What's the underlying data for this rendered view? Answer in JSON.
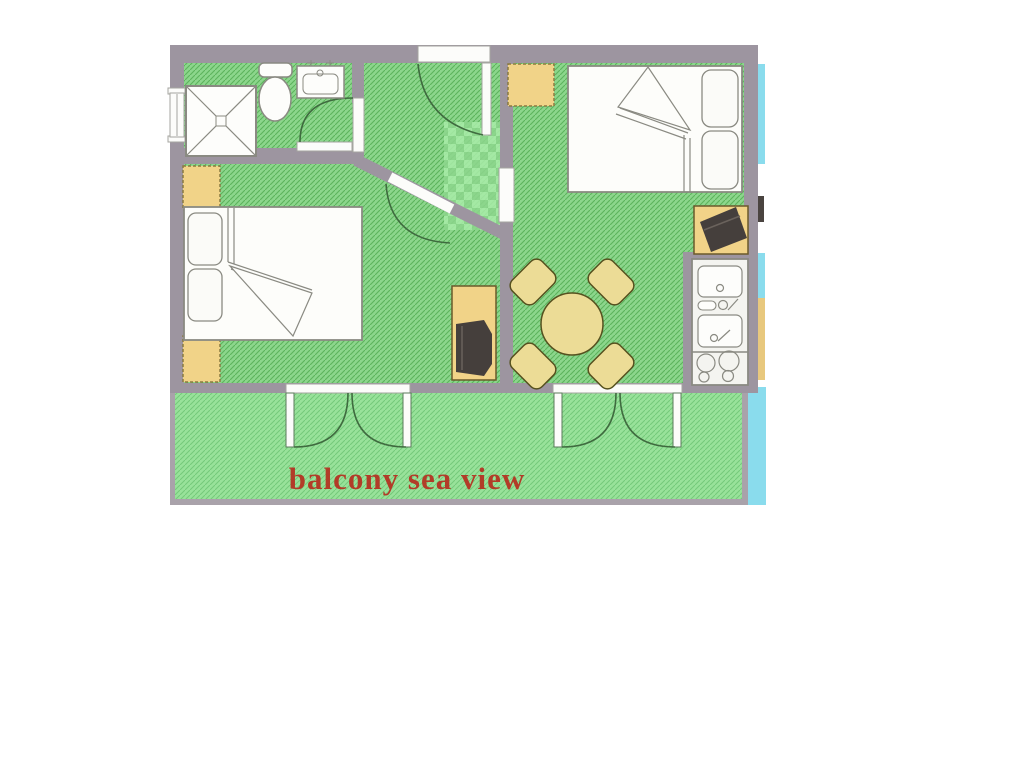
{
  "floorplan": {
    "balcony_label": "balcony sea view",
    "colors": {
      "floor_green": "#8cd68c",
      "floor_hatch": "#5cb35c",
      "balcony_green": "#98e29a",
      "balcony_hatch": "#74c97a",
      "wall_gray": "#9d95a0",
      "furniture_yellow": "#f1d388",
      "table_tan": "#ecdc96",
      "fixture_white": "#fdfdfb",
      "tv_dark": "#453f3c",
      "sea_cyan": "#8adced",
      "label_red": "#b23c28",
      "door_arc": "#3f6b3f"
    }
  }
}
